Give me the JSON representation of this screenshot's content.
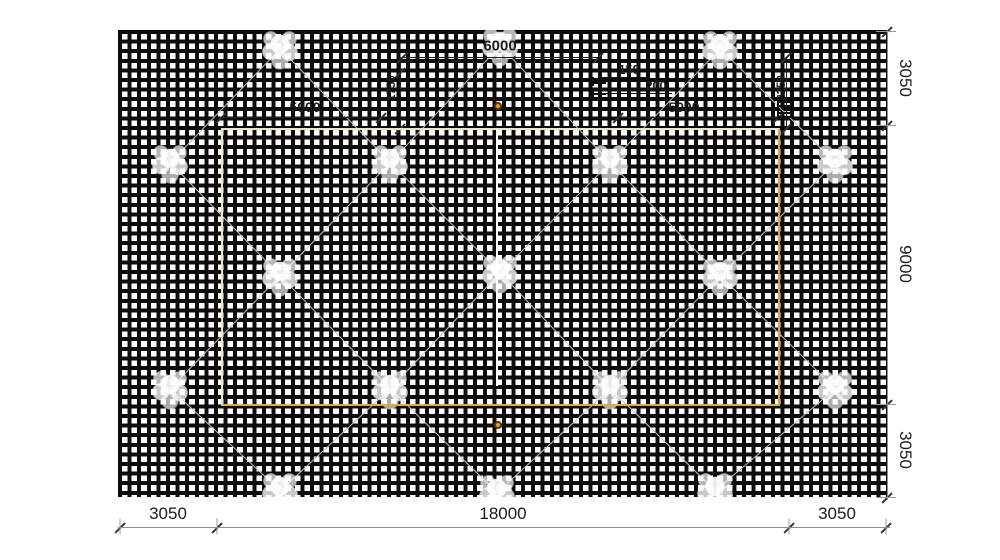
{
  "title": "reinforcement-mesh-plan",
  "dims": {
    "bottom": [
      "3050",
      "18000",
      "3050"
    ],
    "right": [
      "3050",
      "9000",
      "3050"
    ],
    "top_span": "6000",
    "panel_left": "5000",
    "panel_right": "5000",
    "offset_left": "1750",
    "offset_right": "2250",
    "spacing_small": "150",
    "spacing_large": "200"
  },
  "colors": {
    "grid_line": "#0c0c0c",
    "slab_edge_light": "#ece3c8",
    "slab_edge_orange": "#dba338",
    "lattice_line": "#c3c3c3",
    "marker_fill": "#ef9a16",
    "marker_stroke": "#5d340a",
    "dim_line": "#8f8f8f",
    "dim_text": "#1c1c1c"
  },
  "geometry": {
    "grid": {
      "x": 118,
      "y": 30,
      "w": 770,
      "h": 467
    },
    "blobs": [
      [
        280,
        48
      ],
      [
        500,
        45
      ],
      [
        720,
        48
      ],
      [
        170,
        162
      ],
      [
        390,
        162
      ],
      [
        610,
        162
      ],
      [
        835,
        162
      ],
      [
        280,
        275
      ],
      [
        500,
        272
      ],
      [
        720,
        275
      ],
      [
        170,
        388
      ],
      [
        390,
        388
      ],
      [
        610,
        388
      ],
      [
        835,
        388
      ],
      [
        280,
        490
      ],
      [
        497,
        492
      ],
      [
        715,
        490
      ]
    ],
    "bottom_dim": {
      "y": 527,
      "ticks": [
        120,
        217,
        789,
        886
      ]
    },
    "right_dim": {
      "x": 887,
      "ticks": [
        31,
        125,
        404,
        497
      ]
    },
    "top_dim": {
      "y": 57,
      "ends": [
        402,
        598
      ]
    },
    "v1750": {
      "x": 400,
      "ticks": [
        72,
        128
      ]
    },
    "v2250": {
      "x": 786,
      "ticks": [
        57,
        128
      ]
    },
    "dim5000": [
      {
        "y": 117,
        "x1": 221,
        "x2": 381
      },
      {
        "y": 117,
        "x1": 618,
        "x2": 778
      }
    ],
    "bar_symbols": [
      [
        593,
        78
      ],
      [
        593,
        89
      ],
      [
        778,
        101
      ],
      [
        778,
        112
      ]
    ]
  }
}
